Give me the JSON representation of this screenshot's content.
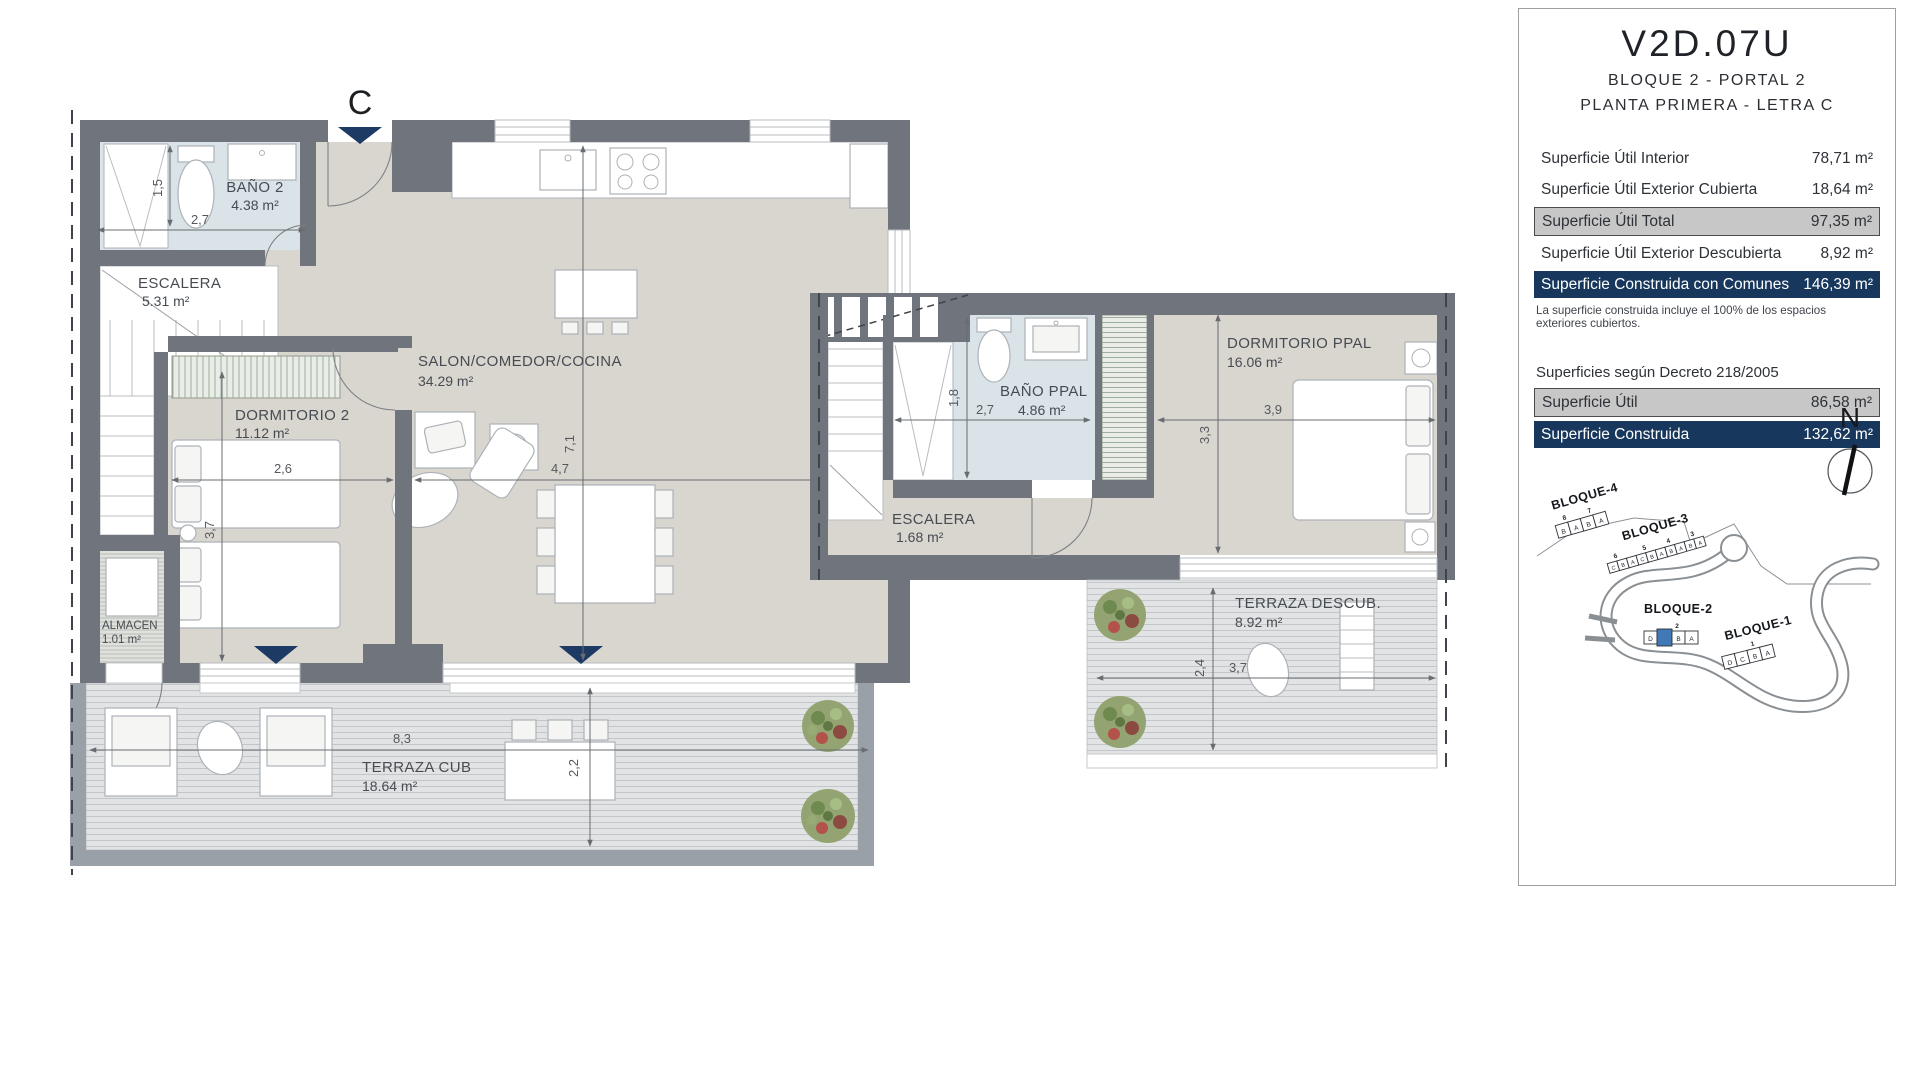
{
  "panel": {
    "unit_code": "V2D.07U",
    "subtitle1": "BLOQUE 2 - PORTAL 2",
    "subtitle2": "PLANTA PRIMERA - LETRA C",
    "surface_rows": [
      {
        "label": "Superficie Útil Interior",
        "value": "78,71 m²",
        "style": "plain"
      },
      {
        "label": "Superficie Útil Exterior Cubierta",
        "value": "18,64 m²",
        "style": "plain"
      },
      {
        "label": "Superficie Útil Total",
        "value": "97,35 m²",
        "style": "gray"
      },
      {
        "label": "Superficie Útil Exterior Descubierta",
        "value": "8,92 m²",
        "style": "plain"
      },
      {
        "label": "Superficie Construida con Comunes",
        "value": "146,39 m²",
        "style": "navy"
      }
    ],
    "note": "La superficie construida incluye el 100% de los espacios exteriores cubiertos.",
    "decree_title": "Superficies según Decreto 218/2005",
    "decree_rows": [
      {
        "label": "Superficie Útil",
        "value": "86,58 m²",
        "style": "gray"
      },
      {
        "label": "Superficie Construida",
        "value": "132,62 m²",
        "style": "navy"
      }
    ],
    "north_label": "N"
  },
  "plan_lower": {
    "entrance_label": "C",
    "rooms": [
      {
        "name": "BAÑO 2",
        "area": "4.38 m²"
      },
      {
        "name": "ESCALERA",
        "area": "5.31 m²"
      },
      {
        "name": "DORMITORIO 2",
        "area": "11.12 m²"
      },
      {
        "name": "SALON/COMEDOR/COCINA",
        "area": "34.29 m²"
      },
      {
        "name": "ALMACEN",
        "area": "1.01 m²"
      },
      {
        "name": "TERRAZA CUB",
        "area": "18.64 m²"
      }
    ],
    "dims": {
      "bano_w": "2,7",
      "bano_h": "1,5",
      "dorm_w": "2,6",
      "dorm_h": "3,7",
      "salon_w": "4,7",
      "salon_h": "7,1",
      "terraza_w": "8,3",
      "terraza_d": "2,2"
    }
  },
  "plan_upper": {
    "rooms": [
      {
        "name": "BAÑO PPAL",
        "area": "4.86 m²"
      },
      {
        "name": "ESCALERA",
        "area": "1.68 m²"
      },
      {
        "name": "DORMITORIO PPAL",
        "area": "16.06 m²"
      },
      {
        "name": "TERRAZA DESCUB.",
        "area": "8.92 m²"
      }
    ],
    "dims": {
      "bano_w": "2,7",
      "bano_h": "1,8",
      "dorm_w": "3,9",
      "dorm_h": "3,3",
      "terraza_w": "3,7",
      "terraza_d": "2,4"
    }
  },
  "siteplan": {
    "blocks": [
      {
        "name": "BLOQUE-4",
        "portals": [
          "8",
          "7"
        ],
        "units": [
          "B",
          "A",
          "B",
          "A"
        ]
      },
      {
        "name": "BLOQUE-3",
        "portals": [
          "6",
          "5",
          "4",
          "3"
        ],
        "units": [
          "C",
          "B",
          "A",
          "C",
          "B",
          "A",
          "B",
          "A",
          "B",
          "A"
        ]
      },
      {
        "name": "BLOQUE-2",
        "portals": [
          "2"
        ],
        "units": [
          "D",
          "C",
          "B",
          "A"
        ],
        "highlighted_unit": "C"
      },
      {
        "name": "BLOQUE-1",
        "portals": [
          "1"
        ],
        "units": [
          "D",
          "C",
          "B",
          "A"
        ]
      }
    ]
  },
  "colors": {
    "navy": "#17375c",
    "highlight_gray": "#c7c7c7",
    "wall": "#70757d",
    "unit_highlight": "#4079b5",
    "bath_floor": "#dae3e8",
    "floor": "#d9d5cf"
  }
}
